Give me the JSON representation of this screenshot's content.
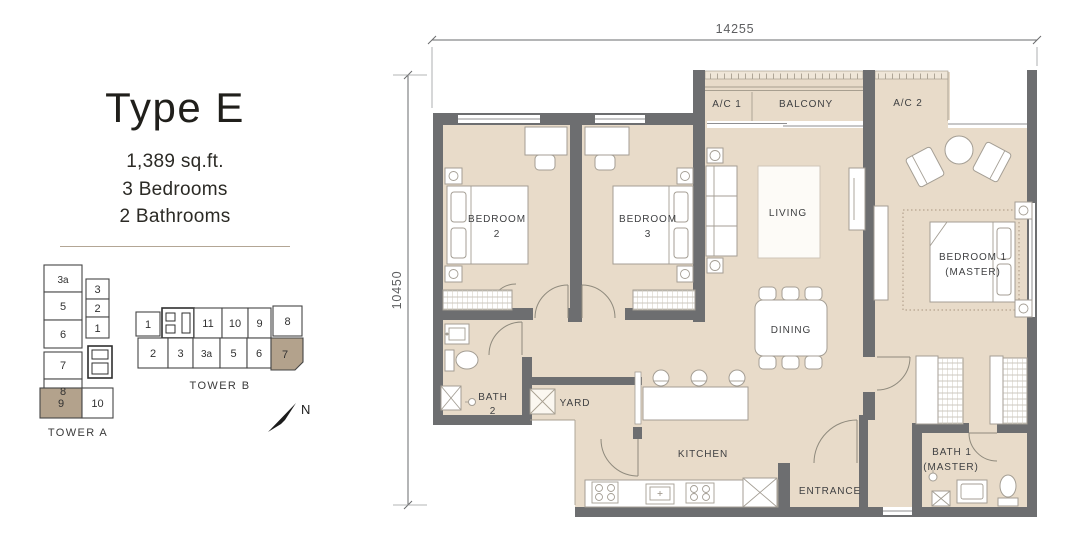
{
  "panel": {
    "title": "Type E",
    "area": "1,389 sq.ft.",
    "bedrooms": "3 Bedrooms",
    "bathrooms": "2 Bathrooms"
  },
  "dimensions": {
    "top": "14255",
    "left": "10450"
  },
  "compass": {
    "north": "N"
  },
  "towers": {
    "tower_a": {
      "label": "TOWER A",
      "left_column": [
        "3a",
        "5",
        "6",
        "7",
        "8"
      ],
      "right_column": [
        "3",
        "2",
        "1"
      ],
      "bottom_row": [
        "9",
        "10"
      ],
      "highlighted_unit": "9"
    },
    "tower_b": {
      "label": "TOWER B",
      "top_row": [
        "1",
        "11",
        "10",
        "9",
        "8"
      ],
      "bottom_row": [
        "2",
        "3",
        "3a",
        "5",
        "6",
        "7"
      ],
      "highlighted_unit": "7"
    }
  },
  "rooms": {
    "ac1": "A/C 1",
    "balcony": "BALCONY",
    "ac2": "A/C 2",
    "bedroom2": [
      "BEDROOM",
      "2"
    ],
    "bedroom3": [
      "BEDROOM",
      "3"
    ],
    "living": "LIVING",
    "dining": "DINING",
    "master": [
      "BEDROOM 1",
      "(MASTER)"
    ],
    "bath2": [
      "BATH",
      "2"
    ],
    "bath1": [
      "BATH 1",
      "(MASTER)"
    ],
    "yard": "YARD",
    "kitchen": "KITCHEN",
    "entrance": "ENTRANCE"
  },
  "colors": {
    "floor": "#e8dbc9",
    "wall": "#6d6e70",
    "highlight": "#b3a28c",
    "label_text": "#3f4042",
    "dimension_text": "#5d5e60",
    "divider": "#b3a695"
  }
}
